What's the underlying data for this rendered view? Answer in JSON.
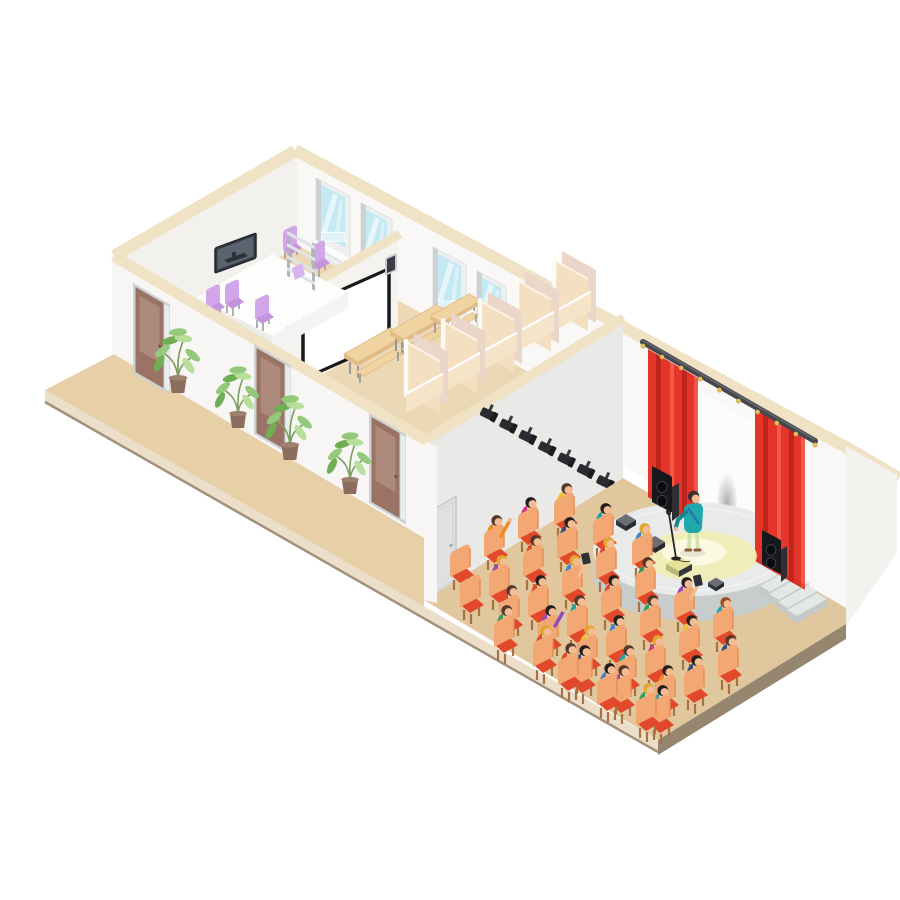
{
  "scene": {
    "kind": "isometric-concert-hall-cutaway",
    "areas": [
      "office-room",
      "projection-room",
      "cloakroom-stalls",
      "corridor-terrace",
      "concert-hall",
      "stage"
    ]
  },
  "colors": {
    "bg": "#ffffff",
    "rim": "#f0e2c5",
    "wallFront": "#f7f6f4",
    "wallGable": "#f2f1ee",
    "wallBack": "#f9f8f6",
    "wallPartition": "#f4f3f0",
    "wallHall": "#e9e9e7",
    "wallRight": "#f3f2ee",
    "backdrop": "#fcfcfa",
    "terrace": "#e7d0a8",
    "hallFloor": "#e0c79d",
    "interiorFloor": "#ecd8b5",
    "bandLight": "#ebdfca",
    "bandDark": "#97866f",
    "edgeLine": "#a2927c",
    "stall": "#f4dfc1",
    "stallPink": "#ead7ca",
    "stallPost": "#fdfaf4",
    "stallLow": "#f6e4c9",
    "bench": "#f1d3a1",
    "benchSide": "#e0bb86",
    "benchLeg": "#8e9296",
    "door": "#9b7365",
    "doorPanel": "#ae8a7c",
    "doorFrame": "#ccd2d4",
    "doorGlass": "#e9edee",
    "grayDoor": "#dde1e2",
    "windowFrame": "#eef0f0",
    "windowJamb": "#cdd1d3",
    "glass": "#c5e9f3",
    "glassLight": "#ddf3f9",
    "sill": "#fbfcfc",
    "screenBorder": "#191a1d",
    "screenFace": "#ffffff",
    "wallSpeakerFrame": "#caced2",
    "wallSpeakerDark": "#3a3e44",
    "tv": "#343a42",
    "tvScreen": "#5a646f",
    "tvStand": "#2e3238",
    "table": "#fdfdfc",
    "tableSkirtL": "#ececea",
    "tableSkirtR": "#f4f4f2",
    "chairPurple": "#d2a7e9",
    "chairPurpleDark": "#c495dd",
    "shelfRail": "#aeb4ba",
    "shelf": "#dfe3e6",
    "paper": "#d9b3ee",
    "plantPot": "#8c6d5d",
    "potRim": "#9f8170",
    "stem": "#7c9f5e",
    "leaf": "#93c979",
    "leafDark": "#6fae55",
    "leafLight": "#b8de9b",
    "stageTop": "#e8ebea",
    "stageSide": "#c6cdcc",
    "stageRim": "#f4f6f5",
    "step": "#e3e7e6",
    "stepSide": "#c2c9c8",
    "curtain": "#e5352b",
    "curtainDark": "#bf251d",
    "curtainLight": "#ef5a4b",
    "rail": "#46474d",
    "railHi": "#63646b",
    "ring": "#e7c35a",
    "speaker": "#17181b",
    "speakerSide": "#2d2f34",
    "speakerCone": "#0a0b0d",
    "speakerRing": "#3c3f45",
    "wedge": "#33363b",
    "wedgeTop": "#6a6e74",
    "wedgeDark": "#26282c",
    "wedgeLit": "#b8b577",
    "wedgeLitTop": "#e6e29a",
    "pool": "#f2edb4",
    "poolCore": "#fbfae3",
    "mic": "#26272b",
    "skin": "#f2bd95",
    "perfShirt": "#1fa9ad",
    "perfShirtDark": "#16858f",
    "perfPants": "#cfe3ad",
    "perfShoe": "#8d5a3c",
    "perfHair": "#3a3330",
    "strap": "#2c6fad",
    "chairBack": "#f3a873",
    "chairSeat": "#e2492a",
    "chairLeg": "#aa7242",
    "spotBody": "#2b2c31",
    "spotDark": "#1b1c20",
    "spotMount": "#3a3b40",
    "tablet": "#2e3238"
  },
  "layout": {
    "windows": [
      {
        "x": 316,
        "y": 178,
        "w": 34,
        "h": 76
      },
      {
        "x": 361,
        "y": 203,
        "w": 31,
        "h": 74
      },
      {
        "x": 433,
        "y": 247,
        "w": 33,
        "h": 76
      },
      {
        "x": 477,
        "y": 271,
        "w": 29,
        "h": 74
      }
    ],
    "doors": [
      [
        133,
        283
      ],
      [
        254,
        344
      ],
      [
        369,
        413
      ]
    ],
    "plants": [
      {
        "p": [
          178,
          393
        ],
        "s": 1.05
      },
      {
        "p": [
          238,
          428
        ],
        "s": 1.0
      },
      {
        "p": [
          290,
          460
        ],
        "s": 1.05
      },
      {
        "p": [
          350,
          494
        ],
        "s": 1.0
      }
    ],
    "stalls": {
      "start": [
        406,
        394
      ],
      "step": [
        37,
        -20.5
      ],
      "count": 5
    },
    "benches": [
      [
        344,
        354
      ],
      [
        390,
        331
      ],
      [
        430,
        316
      ]
    ],
    "spotlights": {
      "start": [
        489,
        413
      ],
      "step": [
        19.4,
        11.3
      ],
      "count": 10
    },
    "rail": {
      "a": [
        643,
        342
      ],
      "b": [
        815,
        441
      ],
      "rings": 10
    },
    "curtains": [
      {
        "x": 648,
        "y": 349,
        "w": 50,
        "h": 148
      },
      {
        "x": 755,
        "y": 408,
        "w": 50,
        "h": 153
      }
    ],
    "audience": {
      "u": [
        39,
        20
      ],
      "rows": [
        {
          "o": [
            566,
            528
          ],
          "n": 3
        },
        {
          "o": [
            530,
            542
          ],
          "n": 6
        },
        {
          "o": [
            496,
            560
          ],
          "n": 7
        },
        {
          "o": [
            462,
            580
          ],
          "n": 7
        },
        {
          "o": [
            472,
            610
          ],
          "n": 6
        },
        {
          "o": [
            506,
            650
          ],
          "n": 5
        },
        {
          "o": [
            570,
            688
          ],
          "n": 3
        }
      ]
    },
    "shirt_palette": [
      "#e04a2e",
      "#17a7b4",
      "#9349b8",
      "#2d4e7e",
      "#2fa05c",
      "#f0c230",
      "#ef8b22",
      "#d63384",
      "#3f86c8",
      "#4cc3ca"
    ],
    "hair_palette": [
      "#54382b",
      "#241f1c",
      "#e3a52f",
      "#9c4f1e"
    ]
  },
  "audience_people": [
    {
      "s": 5,
      "h": 0
    },
    {
      "s": 1,
      "h": 1
    },
    {
      "s": 8,
      "h": 2
    },
    {
      "s": 7,
      "h": 1
    },
    {
      "s": 3,
      "h": 1
    },
    {
      "s": 0,
      "h": 2
    },
    {
      "s": 4,
      "h": 0
    },
    {
      "s": 2,
      "h": 1,
      "item": "tablet"
    },
    {
      "s": 1,
      "h": 3
    },
    {
      "s": 6,
      "h": 0,
      "raise": true
    },
    {
      "s": 0,
      "h": 0
    },
    {
      "s": 8,
      "h": 2,
      "item": "tablet"
    },
    {
      "s": 0,
      "h": 1
    },
    {
      "s": 4,
      "h": 0
    },
    {
      "s": 5,
      "h": 1
    },
    {
      "s": 3,
      "h": 0
    },
    null,
    {
      "s": 2,
      "h": 2
    },
    {
      "s": 0,
      "h": 1
    },
    {
      "s": 1,
      "h": 0
    },
    {
      "s": 8,
      "h": 1
    },
    {
      "s": 7,
      "h": 2
    },
    {
      "s": 3,
      "h": 1
    },
    null,
    {
      "s": 0,
      "h": 0
    },
    {
      "s": 2,
      "h": 1,
      "raise": true
    },
    {
      "s": 5,
      "h": 2
    },
    {
      "s": 1,
      "h": 0
    },
    {
      "s": 6,
      "h": 1
    },
    {
      "s": 4,
      "h": 0
    },
    {
      "s": 0,
      "h": 2
    },
    {
      "s": 3,
      "h": 1
    },
    {
      "s": 2,
      "h": 0
    },
    {
      "s": 1,
      "h": 1
    },
    {
      "s": 0,
      "h": 0
    },
    {
      "s": 8,
      "h": 1
    },
    {
      "s": 4,
      "h": 2
    }
  ]
}
